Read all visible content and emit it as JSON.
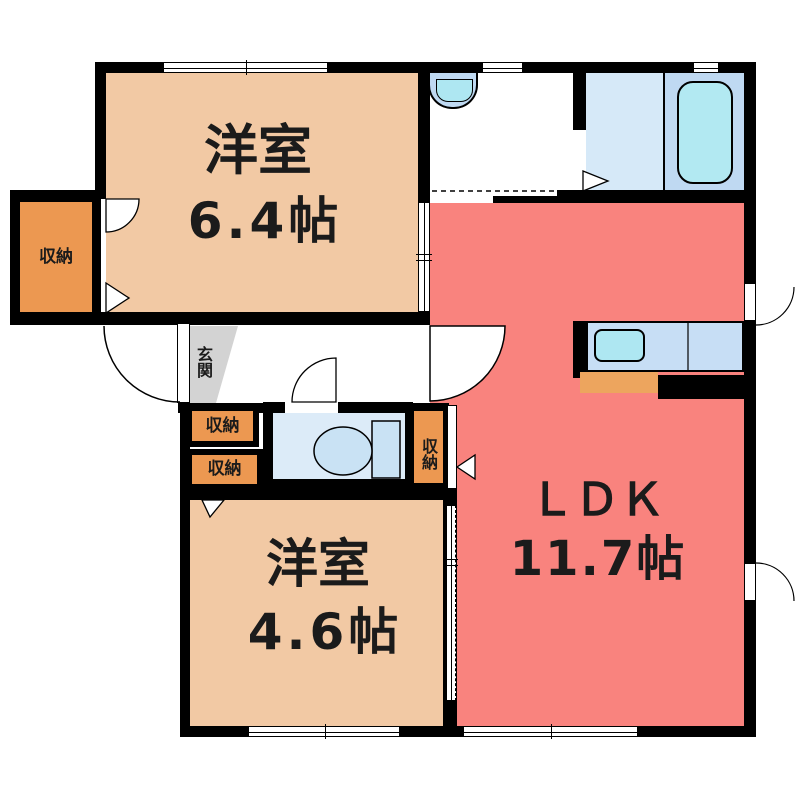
{
  "plan": {
    "type": "apartment-floor-plan",
    "rooms": {
      "bedroom_64": {
        "label": "洋室",
        "size": "6.4帖"
      },
      "bedroom_46": {
        "label": "洋室",
        "size": "4.6帖"
      },
      "ldk": {
        "label": "ＬＤＫ",
        "size": "11.7帖"
      },
      "entrance": {
        "label": "玄関"
      },
      "closet_left": {
        "label": "収納"
      },
      "closet_hall_upper": {
        "label": "収納"
      },
      "closet_hall_lower": {
        "label": "収納"
      },
      "closet_ldk": {
        "label": "収納"
      }
    },
    "fixtures": {
      "toilet": "toilet",
      "bathtub": "bathtub",
      "washbasin": "washbasin",
      "kitchen_sink": "kitchen-counter-with-sink"
    },
    "colors": {
      "wall": "#000000",
      "bedroom_floor": "#F2C9A4",
      "ldk_floor": "#F9837E",
      "closet_fill": "#EC9851",
      "bath_floor": "#D6E9F8",
      "toilet_floor": "#DCEBF8",
      "tub_fill": "#B2E9F2",
      "kitchen_counter": "#C7DEF5",
      "entrance_floor": "#D3D3D3",
      "text": "#1B1B1B"
    }
  }
}
